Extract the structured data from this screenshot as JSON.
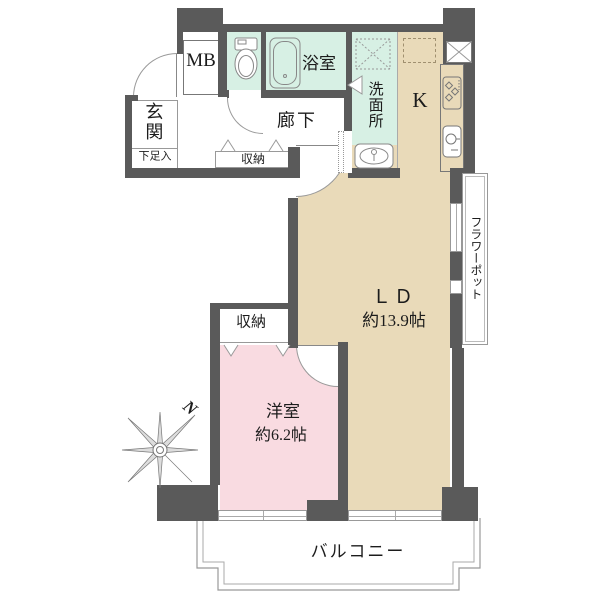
{
  "plan": {
    "rooms": {
      "entrance": {
        "label": "玄関",
        "shoe_label": "下足入"
      },
      "meter_box": {
        "label": "MB"
      },
      "bathroom": {
        "label": "浴室"
      },
      "washroom": {
        "label": "洗面所"
      },
      "kitchen": {
        "label": "K"
      },
      "hallway": {
        "label": "廊下"
      },
      "hall_closet": {
        "label": "収納"
      },
      "bedroom_closet": {
        "label": "収納"
      },
      "living_dining": {
        "label": "ＬＤ",
        "size": "約13.9帖"
      },
      "bedroom": {
        "label": "洋室",
        "size": "約6.2帖"
      },
      "balcony": {
        "label": "バルコニー"
      },
      "flower_pot": {
        "label": "フラワーポット"
      }
    },
    "compass": {
      "north_label": "N"
    },
    "colors": {
      "wall": "#5a5a5a",
      "wet_area_floor": "#d7f0e4",
      "main_floor": "#e9dab9",
      "bedroom_floor": "#f9dbe1",
      "outline": "#999999"
    }
  }
}
